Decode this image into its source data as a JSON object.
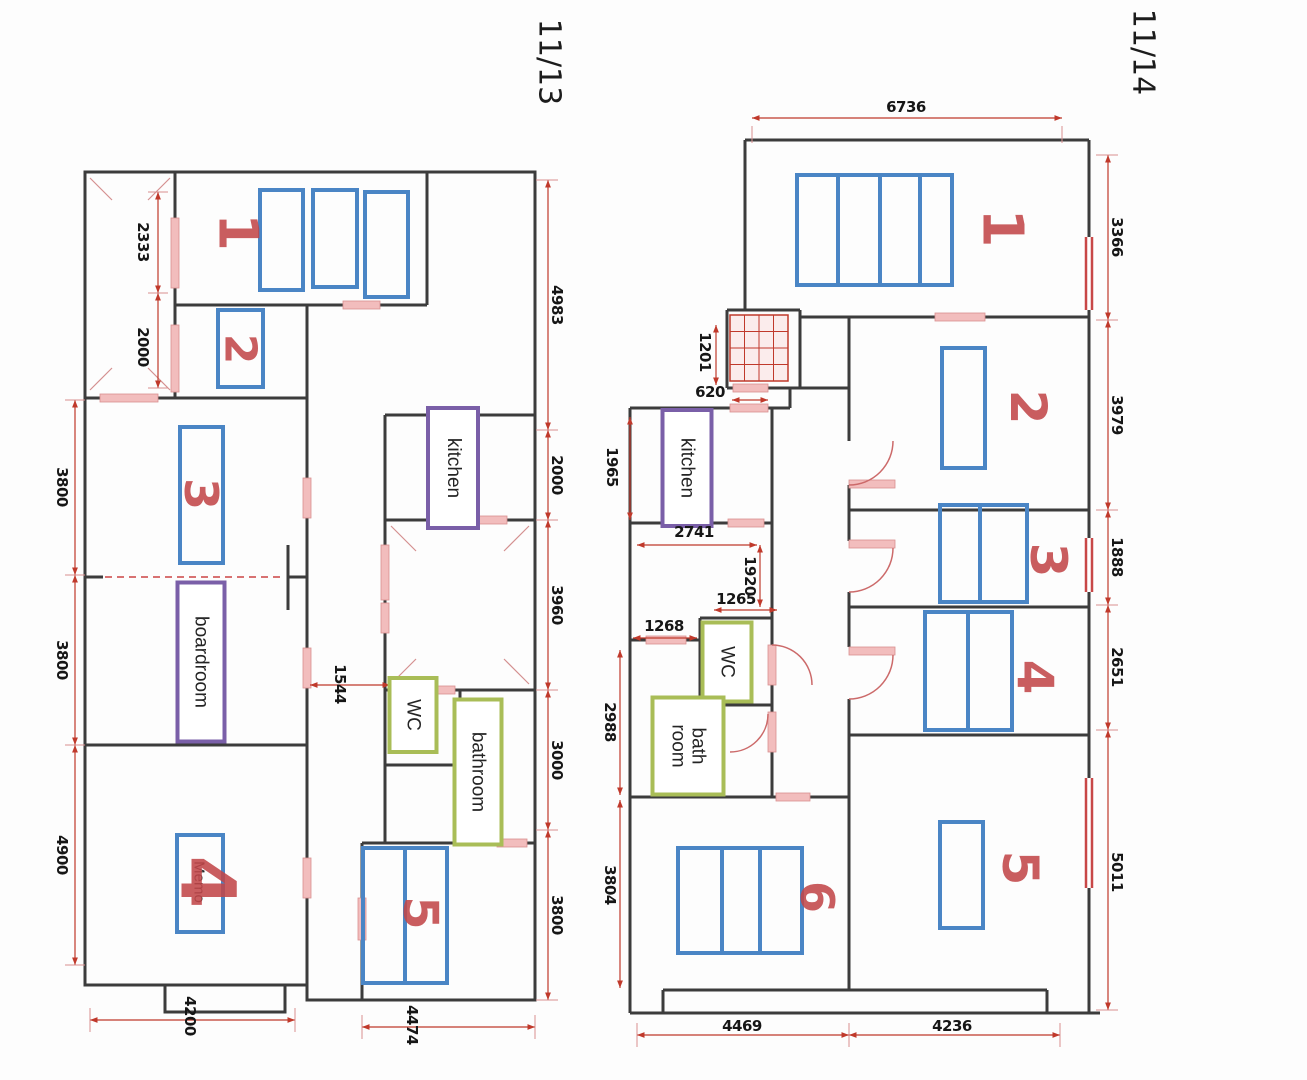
{
  "left_page": {
    "page_number": "11/13",
    "room_numbers": {
      "r1": "1",
      "r2": "2",
      "r3": "3",
      "r4": "4",
      "r5": "5"
    },
    "room_labels": {
      "kitchen": "kitchen",
      "boardroom": "boardroom",
      "wc": "WC",
      "bathroom": "bathroom",
      "memo": "Memo"
    },
    "dims": {
      "left_upper": "2333",
      "left_lower": "2000",
      "outer_top": "3800",
      "outer_mid": "3800",
      "outer_bottom": "4900",
      "right_1": "4983",
      "right_2": "2000",
      "right_3": "3960",
      "right_4": "3000",
      "right_5": "3800",
      "bottom_left": "4200",
      "bottom_right": "4474",
      "corridor": "1544"
    }
  },
  "right_page": {
    "page_number": "11/14",
    "room_numbers": {
      "r1": "1",
      "r2": "2",
      "r3": "3",
      "r4": "4",
      "r5": "5",
      "r6": "6"
    },
    "room_labels": {
      "kitchen": "kitchen",
      "wc": "WC",
      "bath_line1": "bath",
      "bath_line2": "room"
    },
    "dims": {
      "top": "6736",
      "right_1": "3366",
      "right_2": "3979",
      "right_3": "1888",
      "right_4": "2651",
      "right_5": "5011",
      "stairs": "1201",
      "stairs_opening": "620",
      "kitchen_height": "1965",
      "kitchen_width": "2741",
      "hall": "1920",
      "wc_width": "1265",
      "bath_width": "1268",
      "bath_height": "2988",
      "room6_height": "3804",
      "bottom_left": "4469",
      "bottom_right": "4236"
    }
  },
  "colors": {
    "wall": "#3c3c3c",
    "furniture_blue": "#4a85c5",
    "label_purple": "#7a5fa8",
    "label_green": "#a9bd57",
    "dimension_red": "#c0392b",
    "opening_pink": "#f2bdbd",
    "handwriting_red": "#c2474a"
  }
}
